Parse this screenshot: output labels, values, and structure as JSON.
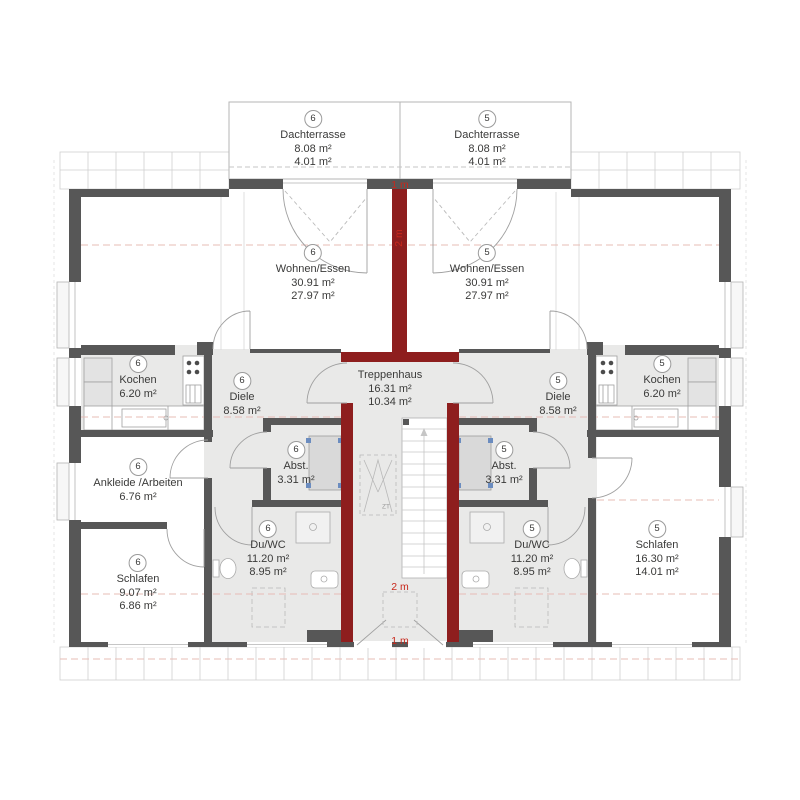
{
  "plan": {
    "colors": {
      "wall_dark": "#575757",
      "wall_red": "#8e1e1e",
      "room_gray": "#e9e9e8",
      "dimension_text_red": "#c8281c",
      "roof_line_pink": "#e7bcb6"
    },
    "rooms": [
      {
        "id": "dachterrasse-6",
        "unit": "6",
        "name": "Dachterrasse",
        "area1": "8.08 m²",
        "area2": "4.01 m²"
      },
      {
        "id": "dachterrasse-5",
        "unit": "5",
        "name": "Dachterrasse",
        "area1": "8.08 m²",
        "area2": "4.01 m²"
      },
      {
        "id": "wohnen-essen-6",
        "unit": "6",
        "name": "Wohnen/Essen",
        "area1": "30.91 m²",
        "area2": "27.97 m²"
      },
      {
        "id": "wohnen-essen-5",
        "unit": "5",
        "name": "Wohnen/Essen",
        "area1": "30.91 m²",
        "area2": "27.97 m²"
      },
      {
        "id": "kochen-6",
        "unit": "6",
        "name": "Kochen",
        "area1": "6.20 m²",
        "area2": ""
      },
      {
        "id": "kochen-5",
        "unit": "5",
        "name": "Kochen",
        "area1": "6.20 m²",
        "area2": ""
      },
      {
        "id": "diele-6",
        "unit": "6",
        "name": "Diele",
        "area1": "8.58 m²",
        "area2": ""
      },
      {
        "id": "diele-5",
        "unit": "5",
        "name": "Diele",
        "area1": "8.58 m²",
        "area2": ""
      },
      {
        "id": "abstellraum-6",
        "unit": "6",
        "name": "Abst.",
        "area1": "3.31 m²",
        "area2": ""
      },
      {
        "id": "abstellraum-5",
        "unit": "5",
        "name": "Abst.",
        "area1": "3.31 m²",
        "area2": ""
      },
      {
        "id": "ankleide-6",
        "unit": "6",
        "name": "Ankleide /Arbeiten",
        "area1": "6.76 m²",
        "area2": ""
      },
      {
        "id": "du-wc-6",
        "unit": "6",
        "name": "Du/WC",
        "area1": "11.20 m²",
        "area2": "8.95 m²"
      },
      {
        "id": "du-wc-5",
        "unit": "5",
        "name": "Du/WC",
        "area1": "11.20 m²",
        "area2": "8.95 m²"
      },
      {
        "id": "schlafen-6",
        "unit": "6",
        "name": "Schlafen",
        "area1": "9.07 m²",
        "area2": "6.86 m²"
      },
      {
        "id": "schlafen-5",
        "unit": "5",
        "name": "Schlafen",
        "area1": "16.30 m²",
        "area2": "14.01 m²"
      },
      {
        "id": "treppenhaus",
        "unit": "",
        "name": "Treppenhaus",
        "area1": "16.31 m²",
        "area2": "10.34 m²"
      }
    ],
    "dimension_labels": {
      "top": "1 m",
      "upper_vertical": "2 m",
      "lower": "2 m",
      "bottom": "1 m"
    },
    "stair_symbol_label": "ZT"
  }
}
